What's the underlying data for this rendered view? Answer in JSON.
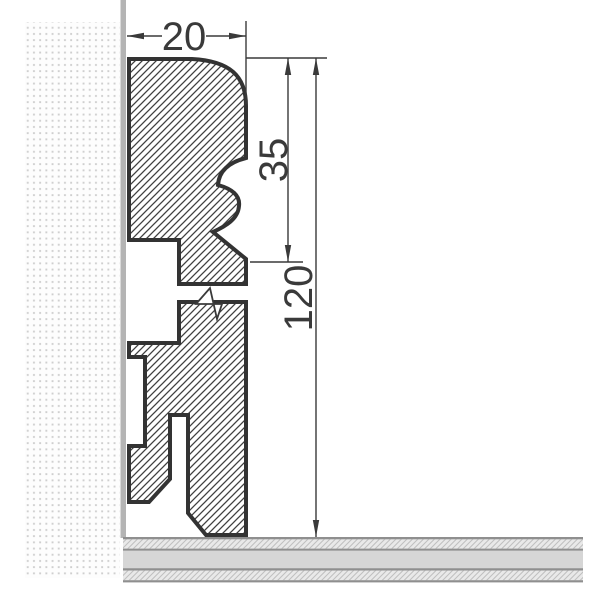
{
  "drawing": {
    "title": "skirting-board-cross-section",
    "description": "Technical cross-section drawing of a skirting board profile mounted on a wall above a floor, with a break mark in the middle of the board",
    "dimensions": {
      "width": {
        "value": "20",
        "orientation": "horizontal",
        "measures": "profile depth from wall"
      },
      "upper_height": {
        "value": "35",
        "orientation": "vertical",
        "measures": "decorative top moulding height"
      },
      "total_height": {
        "value": "120",
        "orientation": "vertical",
        "measures": "total skirting height above floor"
      }
    },
    "colors": {
      "background": "#ffffff",
      "outline": "#333333",
      "hatch_line": "#404040",
      "hatch_background": "#ffffff",
      "wall_dot": "#cfcfcf",
      "wall_face": "#b4b4b4",
      "floor_border": "#8f8f8f",
      "floor_core": "#d6d6d6",
      "floor_screed_background": "#e9e9e9",
      "floor_screed_hatch": "#bfbfbf",
      "dimension_line": "#3a3a3a",
      "dimension_text": "#3a3a3a"
    },
    "parts": {
      "wall": "stippled wall behind profile",
      "wall_face": "wall surface line",
      "floor": "three-layer floor slab",
      "upper_section": "ogee moulded top section",
      "lower_section": "main board with clip grooves and foot",
      "break_mark": "zigzag break symbol indicating omitted length"
    }
  }
}
